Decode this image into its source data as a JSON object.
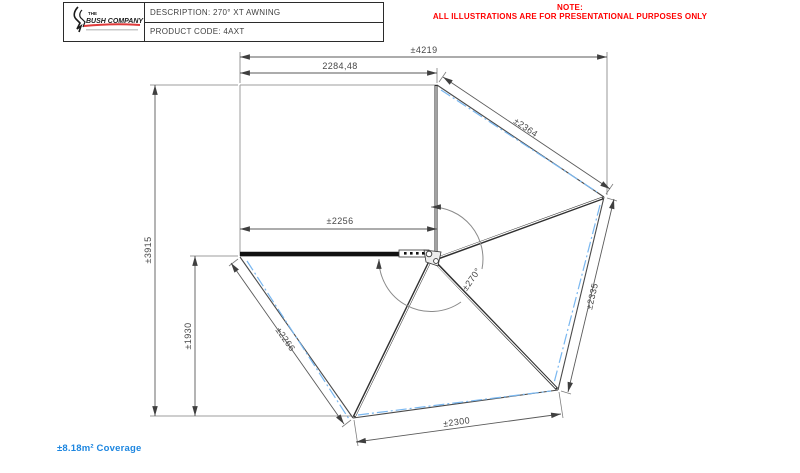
{
  "title_block": {
    "brand_the": "THE",
    "brand_name": "BUSH COMPANY",
    "description": "DESCRIPTION: 270° XT AWNING",
    "product_code": "PRODUCT CODE: 4AXT"
  },
  "note": {
    "heading": "NOTE:",
    "body": "ALL ILLUSTRATIONS ARE FOR PRESENTATIONAL PURPOSES ONLY"
  },
  "drawing": {
    "dim_overall_width": "±4219",
    "dim_panel_width": "2284,48",
    "dim_overall_height": "±3915",
    "dim_drop_height": "±1930",
    "dim_rail_length": "±2256",
    "dim_fan_panel_top": "±2364",
    "dim_fan_panel_right": "±2335",
    "dim_fan_panel_bottom": "±2300",
    "dim_fan_panel_left": "±2266",
    "angle_label": "±270°"
  },
  "footer": {
    "coverage": "±8.18m² Coverage"
  },
  "colors": {
    "note_red": "#FF0000",
    "coverage_blue": "#1D86E0",
    "centerline_blue": "#79B7F0",
    "line_gray": "#4A4A4A"
  }
}
